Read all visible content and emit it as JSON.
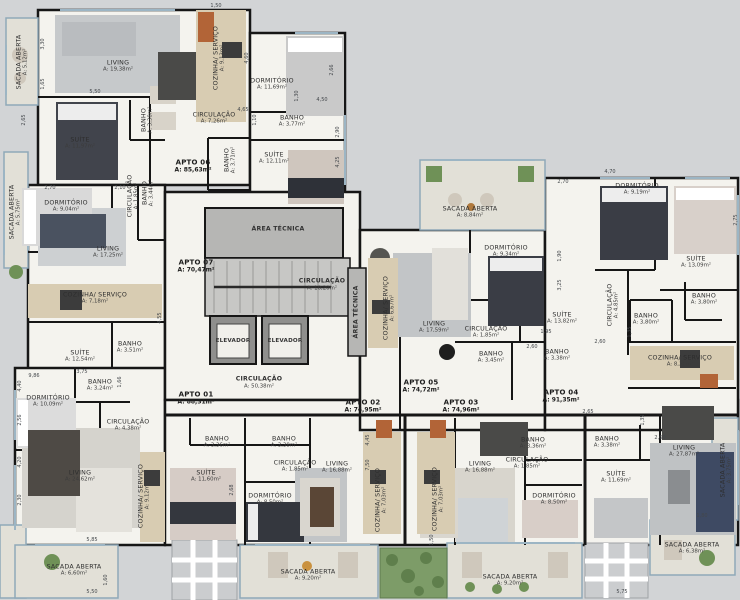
{
  "meta": {
    "kind": "architectural floor plan",
    "language": "pt-BR",
    "unit": "m²"
  },
  "palette": {
    "background": "#d2d4d6",
    "floor": "#f4f3ee",
    "wall": "#161616",
    "balcony": "#e2e0d7",
    "window_accent": "#9cb5c4",
    "technical_gray": "#b6b6b4",
    "stair_gray": "#c7c7c5",
    "garden_green": "#7d9c68",
    "furniture_orange": "#b26437"
  },
  "apartments": [
    {
      "n": "APTO 06",
      "a": "A: 85,63m²",
      "x": 193,
      "y": 167
    },
    {
      "n": "APTO 07",
      "a": "A: 70,47m²",
      "x": 196,
      "y": 267
    },
    {
      "n": "APTO 01",
      "a": "A: 88,31m²",
      "x": 196,
      "y": 399
    },
    {
      "n": "APTO 02",
      "a": "A: 74,95m²",
      "x": 363,
      "y": 407
    },
    {
      "n": "APTO 05",
      "a": "A: 74,72m²",
      "x": 421,
      "y": 387
    },
    {
      "n": "APTO 03",
      "a": "A: 74,96m²",
      "x": 461,
      "y": 407
    },
    {
      "n": "APTO 04",
      "a": "A: 91,35m²",
      "x": 561,
      "y": 397
    }
  ],
  "rooms": [
    {
      "n": "SACADA ABERTA",
      "a": "A: 5,12m²",
      "x": 22,
      "y": 62,
      "r": 1
    },
    {
      "n": "LIVING",
      "a": "A: 19,38m²",
      "x": 118,
      "y": 66
    },
    {
      "n": "COZINHA/ SERVIÇO",
      "a": "A: 9,13m²",
      "x": 219,
      "y": 58,
      "r": 1
    },
    {
      "n": "SUÍTE",
      "a": "A: 11,97m²",
      "x": 80,
      "y": 143
    },
    {
      "n": "BANHO",
      "a": "A: 3,38m²",
      "x": 147,
      "y": 120,
      "r": 1
    },
    {
      "n": "CIRCULAÇÃO",
      "a": "A: 7,26m²",
      "x": 214,
      "y": 118
    },
    {
      "n": "DORMITÓRIO",
      "a": "A: 11,69m²",
      "x": 272,
      "y": 84
    },
    {
      "n": "BANHO",
      "a": "A: 3,77m²",
      "x": 292,
      "y": 121
    },
    {
      "n": "SUÍTE",
      "a": "A: 12,11m²",
      "x": 274,
      "y": 158
    },
    {
      "n": "BANHO",
      "a": "A: 3,71m²",
      "x": 230,
      "y": 160,
      "r": 1
    },
    {
      "n": "SACADA ABERTA",
      "a": "A: 5,75m²",
      "x": 15,
      "y": 212,
      "r": 1
    },
    {
      "n": "DORMITÓRIO",
      "a": "A: 9,04m²",
      "x": 66,
      "y": 206
    },
    {
      "n": "CIRCULAÇÃO",
      "a": "A: 1,85m²",
      "x": 133,
      "y": 196,
      "r": 1
    },
    {
      "n": "BANHO",
      "a": "A: 3,44m²",
      "x": 148,
      "y": 193,
      "r": 1
    },
    {
      "n": "LIVING",
      "a": "A: 17,25m²",
      "x": 108,
      "y": 252
    },
    {
      "n": "COZINHA/ SERVIÇO",
      "a": "A: 7,18m²",
      "x": 95,
      "y": 298
    },
    {
      "n": "SUÍTE",
      "a": "A: 12,54m²",
      "x": 80,
      "y": 356
    },
    {
      "n": "BANHO",
      "a": "A: 3,51m²",
      "x": 130,
      "y": 347
    },
    {
      "n": "BANHO",
      "a": "A: 3,24m²",
      "x": 100,
      "y": 385
    },
    {
      "n": "DORMITÓRIO",
      "a": "A: 10,09m²",
      "x": 48,
      "y": 401
    },
    {
      "n": "CIRCULAÇÃO",
      "a": "A: 4,38m²",
      "x": 128,
      "y": 425
    },
    {
      "n": "LIVING",
      "a": "A: 24,62m²",
      "x": 80,
      "y": 476
    },
    {
      "n": "COZINHA/ SERVIÇO",
      "a": "A: 9,12m²",
      "x": 144,
      "y": 496,
      "r": 1
    },
    {
      "n": "SACADA ABERTA",
      "a": "A: 6,60m²",
      "x": 74,
      "y": 570
    },
    {
      "n": "BANHO",
      "a": "A: 3,36m²",
      "x": 217,
      "y": 442
    },
    {
      "n": "SUÍTE",
      "a": "A: 11,60m²",
      "x": 206,
      "y": 476
    },
    {
      "n": "BANHO",
      "a": "A: 3,38m²",
      "x": 284,
      "y": 442
    },
    {
      "n": "CIRCULAÇÃO",
      "a": "A: 1,85m²",
      "x": 295,
      "y": 466
    },
    {
      "n": "DORMITÓRIO",
      "a": "A: 8,50m²",
      "x": 270,
      "y": 499
    },
    {
      "n": "LIVING",
      "a": "A: 16,88m²",
      "x": 337,
      "y": 467
    },
    {
      "n": "COZINHA/ SERVIÇO",
      "a": "A: 7,03m²",
      "x": 381,
      "y": 500,
      "r": 1
    },
    {
      "n": "SACADA ABERTA",
      "a": "A: 9,20m²",
      "x": 308,
      "y": 575
    },
    {
      "n": "COZINHA/ SERVIÇO",
      "a": "A: 7,03m²",
      "x": 438,
      "y": 499,
      "r": 1
    },
    {
      "n": "LIVING",
      "a": "A: 16,88m²",
      "x": 480,
      "y": 467
    },
    {
      "n": "CIRCULAÇÃO",
      "a": "A: 1,85m²",
      "x": 527,
      "y": 463
    },
    {
      "n": "BANHO",
      "a": "A: 3,36m²",
      "x": 533,
      "y": 443
    },
    {
      "n": "DORMITÓRIO",
      "a": "A: 8,50m²",
      "x": 554,
      "y": 499
    },
    {
      "n": "SACADA ABERTA",
      "a": "A: 9,20m²",
      "x": 510,
      "y": 580
    },
    {
      "n": "BANHO",
      "a": "A: 3,38m²",
      "x": 607,
      "y": 442
    },
    {
      "n": "SUÍTE",
      "a": "A: 11,69m²",
      "x": 616,
      "y": 477
    },
    {
      "n": "LIVING",
      "a": "A: 27,87m²",
      "x": 684,
      "y": 451
    },
    {
      "n": "SACADA ABERTA",
      "a": "A: 6,38m²",
      "x": 692,
      "y": 548
    },
    {
      "n": "SACADA ABERTA",
      "a": "A: 3,75m²",
      "x": 726,
      "y": 470,
      "r": 1
    },
    {
      "n": "SACADA ABERTA",
      "a": "A: 8,84m²",
      "x": 470,
      "y": 212
    },
    {
      "n": "DORMITÓRIO",
      "a": "A: 9,34m²",
      "x": 506,
      "y": 251
    },
    {
      "n": "LIVING",
      "a": "A: 17,59m²",
      "x": 434,
      "y": 327
    },
    {
      "n": "COZINHA/ SERVIÇO",
      "a": "A: 6,67m²",
      "x": 389,
      "y": 308,
      "r": 1
    },
    {
      "n": "CIRCULAÇÃO",
      "a": "A: 1,85m²",
      "x": 486,
      "y": 332
    },
    {
      "n": "BANHO",
      "a": "A: 3,45m²",
      "x": 491,
      "y": 357
    },
    {
      "n": "BANHO",
      "a": "A: 3,38m²",
      "x": 557,
      "y": 355
    },
    {
      "n": "SUÍTE",
      "a": "A: 13,82m²",
      "x": 562,
      "y": 318
    },
    {
      "n": "DORMITÓRIO",
      "a": "A: 9,19m²",
      "x": 637,
      "y": 189
    },
    {
      "n": "SUÍTE",
      "a": "A: 13,09m²",
      "x": 696,
      "y": 262
    },
    {
      "n": "CIRCULAÇÃO",
      "a": "A: 4,85m²",
      "x": 613,
      "y": 305,
      "r": 1
    },
    {
      "n": "BANHO",
      "a": "A: 3,80m²",
      "x": 646,
      "y": 319
    },
    {
      "n": "BANHO",
      "a": "A: 3,80m²",
      "x": 704,
      "y": 299
    },
    {
      "n": "COZINHA/ SERVIÇO",
      "a": "A: 8,26m²",
      "x": 680,
      "y": 361
    }
  ],
  "features": [
    {
      "n": "ÁREA TÉCNICA",
      "x": 278,
      "y": 230
    },
    {
      "n": "CIRCULAÇÃO",
      "a": "A: 10,20m²",
      "x": 322,
      "y": 285
    },
    {
      "n": "ÁREA TÉCNICA",
      "x": 357,
      "y": 312,
      "r": 1
    },
    {
      "n": "ELEVADOR",
      "x": 233,
      "y": 341,
      "e": 1
    },
    {
      "n": "ELEVADOR",
      "x": 285,
      "y": 341,
      "e": 1
    },
    {
      "n": "CIRCULAÇÃO",
      "a": "A: 50,38m²",
      "x": 259,
      "y": 383
    }
  ],
  "dimensions": [
    {
      "t": "1,50",
      "x": 216,
      "y": 6
    },
    {
      "t": "4,60",
      "x": 247,
      "y": 58,
      "r": 1
    },
    {
      "t": "3,30",
      "x": 43,
      "y": 44,
      "r": 1
    },
    {
      "t": "1,65",
      "x": 43,
      "y": 84,
      "r": 1
    },
    {
      "t": "5,50",
      "x": 95,
      "y": 92
    },
    {
      "t": "2,66",
      "x": 332,
      "y": 70,
      "r": 1
    },
    {
      "t": "1,30",
      "x": 297,
      "y": 96,
      "r": 1
    },
    {
      "t": "4,50",
      "x": 322,
      "y": 100
    },
    {
      "t": "2,90",
      "x": 338,
      "y": 132,
      "r": 1
    },
    {
      "t": "4,25",
      "x": 338,
      "y": 162,
      "r": 1
    },
    {
      "t": "1,10",
      "x": 255,
      "y": 120,
      "r": 1
    },
    {
      "t": "4,65",
      "x": 243,
      "y": 110
    },
    {
      "t": "2,70",
      "x": 50,
      "y": 188
    },
    {
      "t": "2,10",
      "x": 120,
      "y": 188
    },
    {
      "t": "2,65",
      "x": 24,
      "y": 120,
      "r": 1
    },
    {
      "t": "1,90",
      "x": 560,
      "y": 256,
      "r": 1
    },
    {
      "t": "3,25",
      "x": 560,
      "y": 285,
      "r": 1
    },
    {
      "t": "2,60",
      "x": 532,
      "y": 347
    },
    {
      "t": "1,95",
      "x": 546,
      "y": 332
    },
    {
      "t": "1,35",
      "x": 630,
      "y": 332,
      "r": 1
    },
    {
      "t": "2,60",
      "x": 600,
      "y": 342
    },
    {
      "t": "2,68",
      "x": 232,
      "y": 490,
      "r": 1
    },
    {
      "t": "4,40",
      "x": 20,
      "y": 386,
      "r": 1
    },
    {
      "t": "9,86",
      "x": 34,
      "y": 376
    },
    {
      "t": "3,75",
      "x": 82,
      "y": 372
    },
    {
      "t": "1,66",
      "x": 120,
      "y": 382,
      "r": 1
    },
    {
      "t": "2,56",
      "x": 20,
      "y": 420,
      "r": 1
    },
    {
      "t": "5,50",
      "x": 92,
      "y": 592
    },
    {
      "t": "1,60",
      "x": 106,
      "y": 580,
      "r": 1
    },
    {
      "t": "4,20",
      "x": 20,
      "y": 462,
      "r": 1
    },
    {
      "t": "2,30",
      "x": 20,
      "y": 500,
      "r": 1
    },
    {
      "t": "5,85",
      "x": 92,
      "y": 540
    },
    {
      "t": "4,55",
      "x": 160,
      "y": 318,
      "r": 1
    },
    {
      "t": "7,50",
      "x": 368,
      "y": 465,
      "r": 1
    },
    {
      "t": "4,45",
      "x": 368,
      "y": 440,
      "r": 1
    },
    {
      "t": "1,50",
      "x": 432,
      "y": 540,
      "r": 1
    },
    {
      "t": "2,70",
      "x": 563,
      "y": 182
    },
    {
      "t": "4,70",
      "x": 610,
      "y": 172
    },
    {
      "t": "2,65",
      "x": 588,
      "y": 412
    },
    {
      "t": "2,60",
      "x": 660,
      "y": 438
    },
    {
      "t": "1,35",
      "x": 643,
      "y": 420,
      "r": 1
    },
    {
      "t": "5,75",
      "x": 622,
      "y": 592
    },
    {
      "t": "2,75",
      "x": 736,
      "y": 220,
      "r": 1
    },
    {
      "t": "1,80",
      "x": 702,
      "y": 516
    }
  ]
}
